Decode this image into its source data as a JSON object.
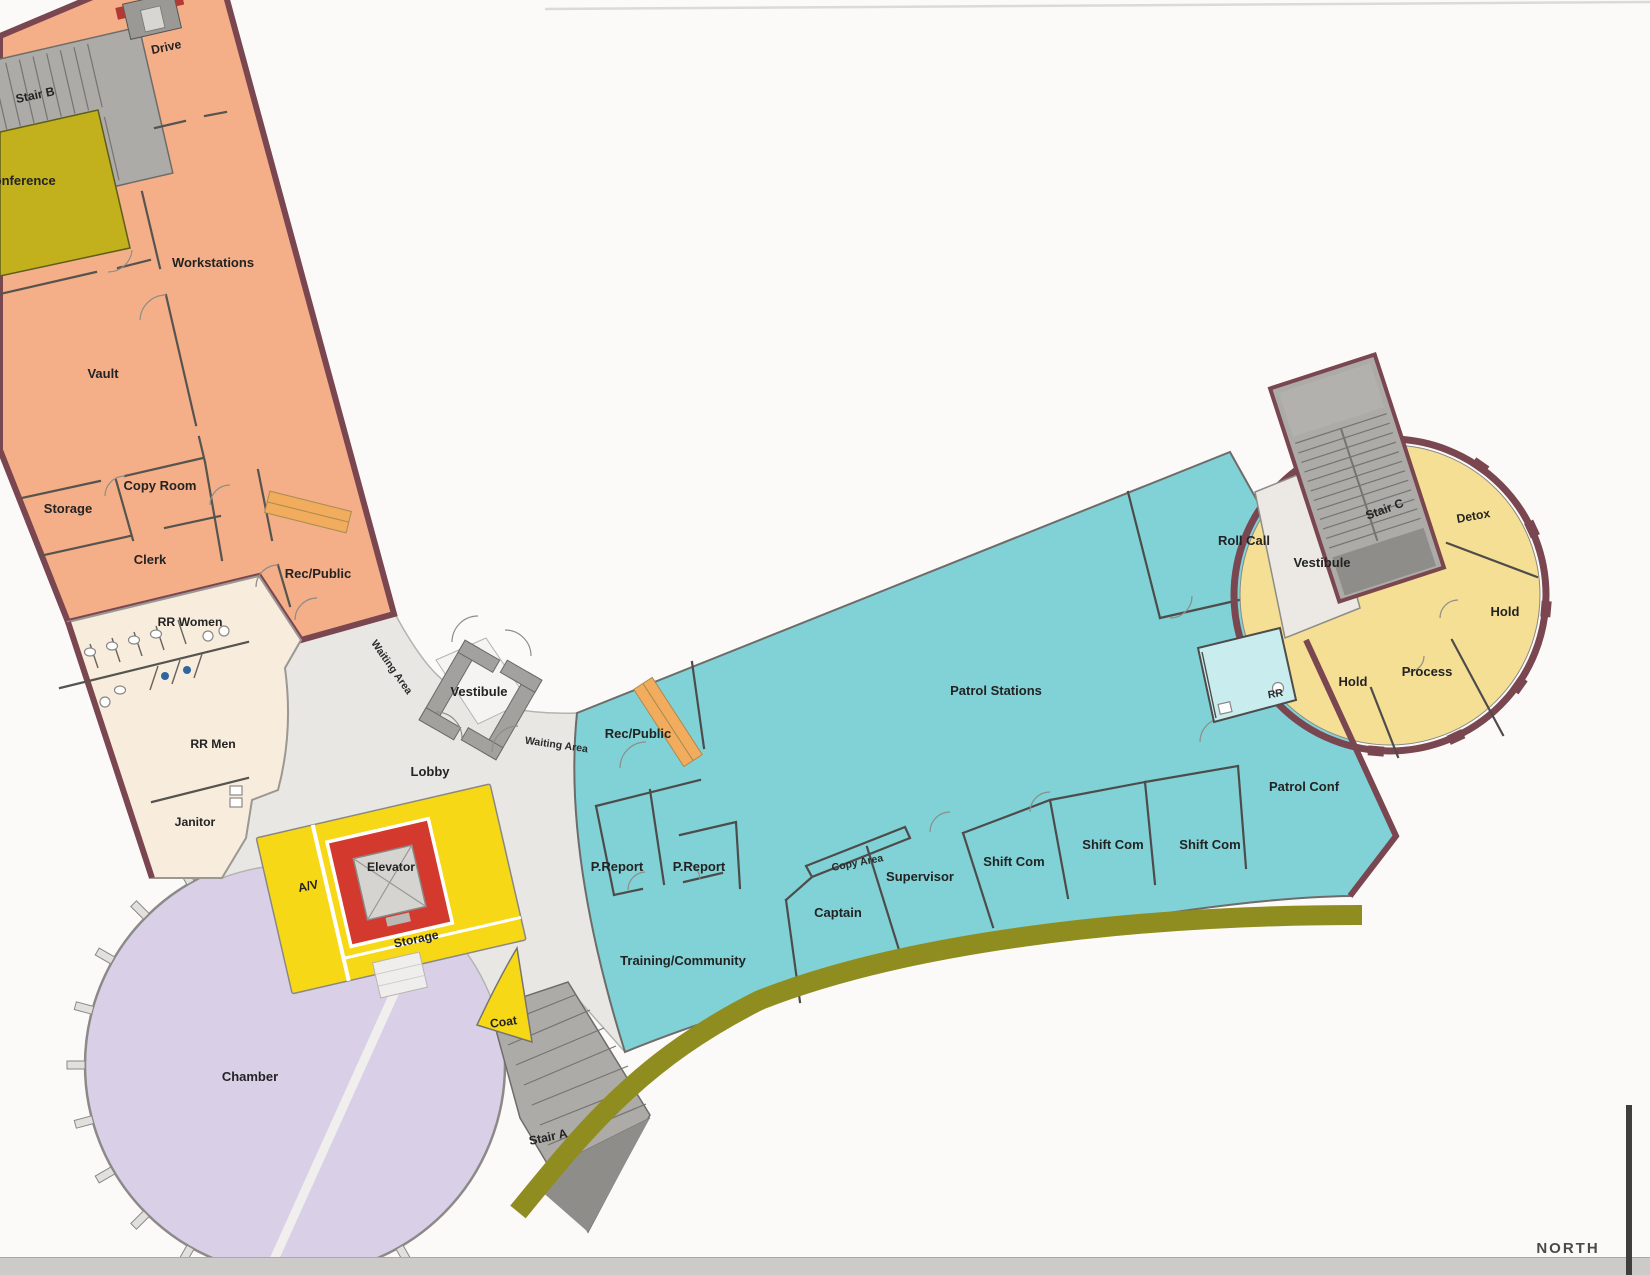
{
  "document": {
    "type": "scanned floor plan",
    "compass_label": "NORTH"
  },
  "palette": {
    "wall_maroon": "#7A4650",
    "admin_orange": "#F4AF88",
    "conference_olive": "#C2B01D",
    "restroom_beige": "#F8ECDD",
    "lobby_gray": "#E9E7E3",
    "core_yellow": "#F7D816",
    "elevator_red": "#D4392E",
    "chamber_purple": "#D9D0E8",
    "patrol_teal": "#80D2D6",
    "holding_yellow": "#F5DF95",
    "stair_gray": "#ACABA7",
    "stair_dark": "#8F8D89",
    "site_band_olive": "#8F8D1F",
    "counter_orange": "#F2AC5E",
    "rr_blue": "#C9ECEF",
    "vestibule_gray": "#ECE9E4"
  },
  "labels": {
    "drive": "Drive",
    "stair_b": "Stair B",
    "conference": "Conference",
    "workstations": "Workstations",
    "vault": "Vault",
    "copy_room": "Copy Room",
    "storage_admin": "Storage",
    "clerk": "Clerk",
    "rec_public_admin": "Rec/Public",
    "rr_women": "RR Women",
    "rr_men": "RR Men",
    "janitor": "Janitor",
    "waiting_area_left": "Waiting Area",
    "vestibule_main": "Vestibule",
    "waiting_area_right": "Waiting Area",
    "lobby": "Lobby",
    "av": "A/V",
    "elevator": "Elevator",
    "storage_core": "Storage",
    "coat": "Coat",
    "chamber": "Chamber",
    "stair_a": "Stair A",
    "training_community": "Training/Community",
    "p_report_1": "P.Report",
    "p_report_2": "P.Report",
    "copy_area": "Copy Area",
    "captain": "Captain",
    "supervisor": "Supervisor",
    "shift_com_1": "Shift Com",
    "shift_com_2": "Shift Com",
    "shift_com_3": "Shift Com",
    "patrol_stations": "Patrol Stations",
    "rec_public_patrol": "Rec/Public",
    "roll_call": "Roll Call",
    "vestibule_patrol": "Vestibule",
    "stair_c": "Stair C",
    "detox": "Detox",
    "hold_east": "Hold",
    "process": "Process",
    "hold_west": "Hold",
    "rr_patrol": "RR",
    "patrol_conf": "Patrol Conf",
    "north": "NORTH"
  }
}
